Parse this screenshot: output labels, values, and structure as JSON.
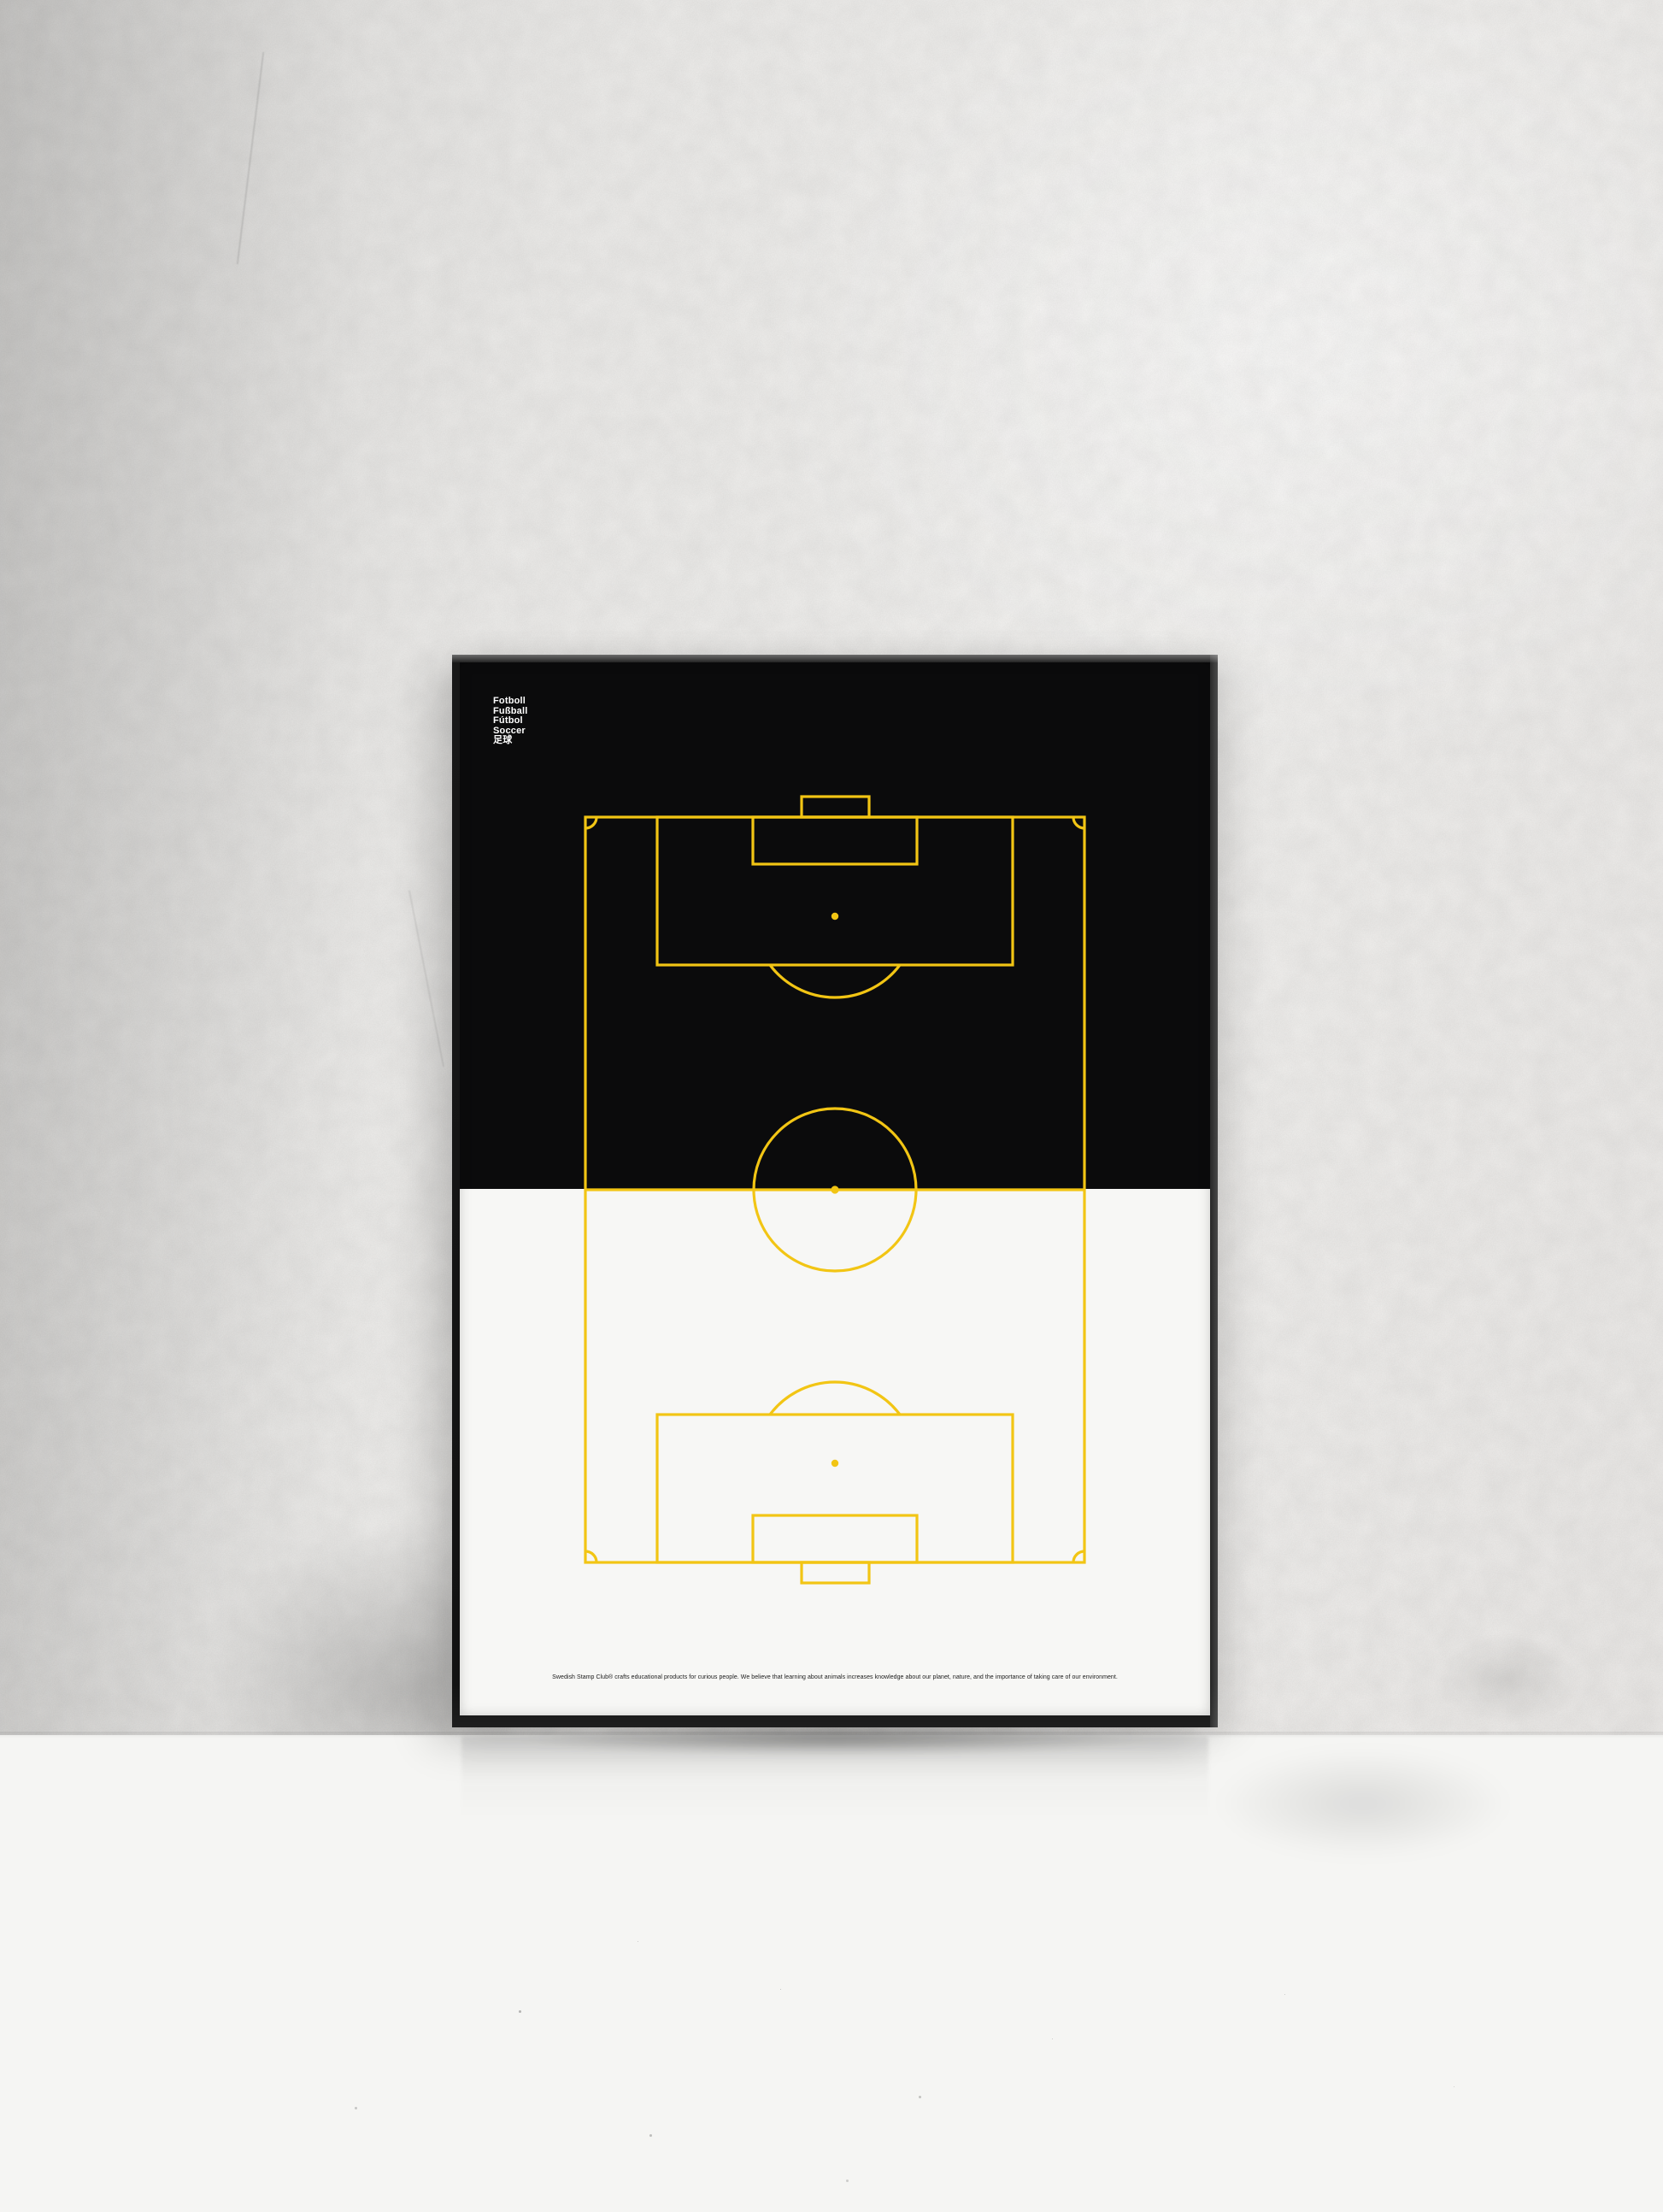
{
  "scene": {
    "description": "Framed minimalist football pitch poster leaning against a white plaster wall on a white floor"
  },
  "poster": {
    "title_lines": [
      "Fotboll",
      "Fußball",
      "Fútbol",
      "Soccer",
      "足球"
    ],
    "caption": "Swedish Stamp Club® crafts educational products for curious people. We believe that learning about animals increases knowledge about our planet, nature, and the importance of taking care of our environment."
  },
  "colors": {
    "pitch_yellow": "#F2C514",
    "poster_black": "#0B0B0C",
    "poster_white": "#F7F7F5",
    "frame_black": "#161616",
    "title_text": "#FFFFFF",
    "caption_text": "#1A1A1A"
  },
  "diagram": {
    "type": "football-pitch",
    "orientation": "vertical",
    "elements": [
      "outer-boundary",
      "halfway-line",
      "center-circle",
      "center-spot",
      "penalty-area-top",
      "goal-area-top",
      "goal-top",
      "penalty-spot-top",
      "penalty-arc-top",
      "penalty-area-bottom",
      "goal-area-bottom",
      "goal-bottom",
      "penalty-spot-bottom",
      "penalty-arc-bottom",
      "corner-arc-top-left",
      "corner-arc-top-right",
      "corner-arc-bottom-left",
      "corner-arc-bottom-right"
    ]
  }
}
